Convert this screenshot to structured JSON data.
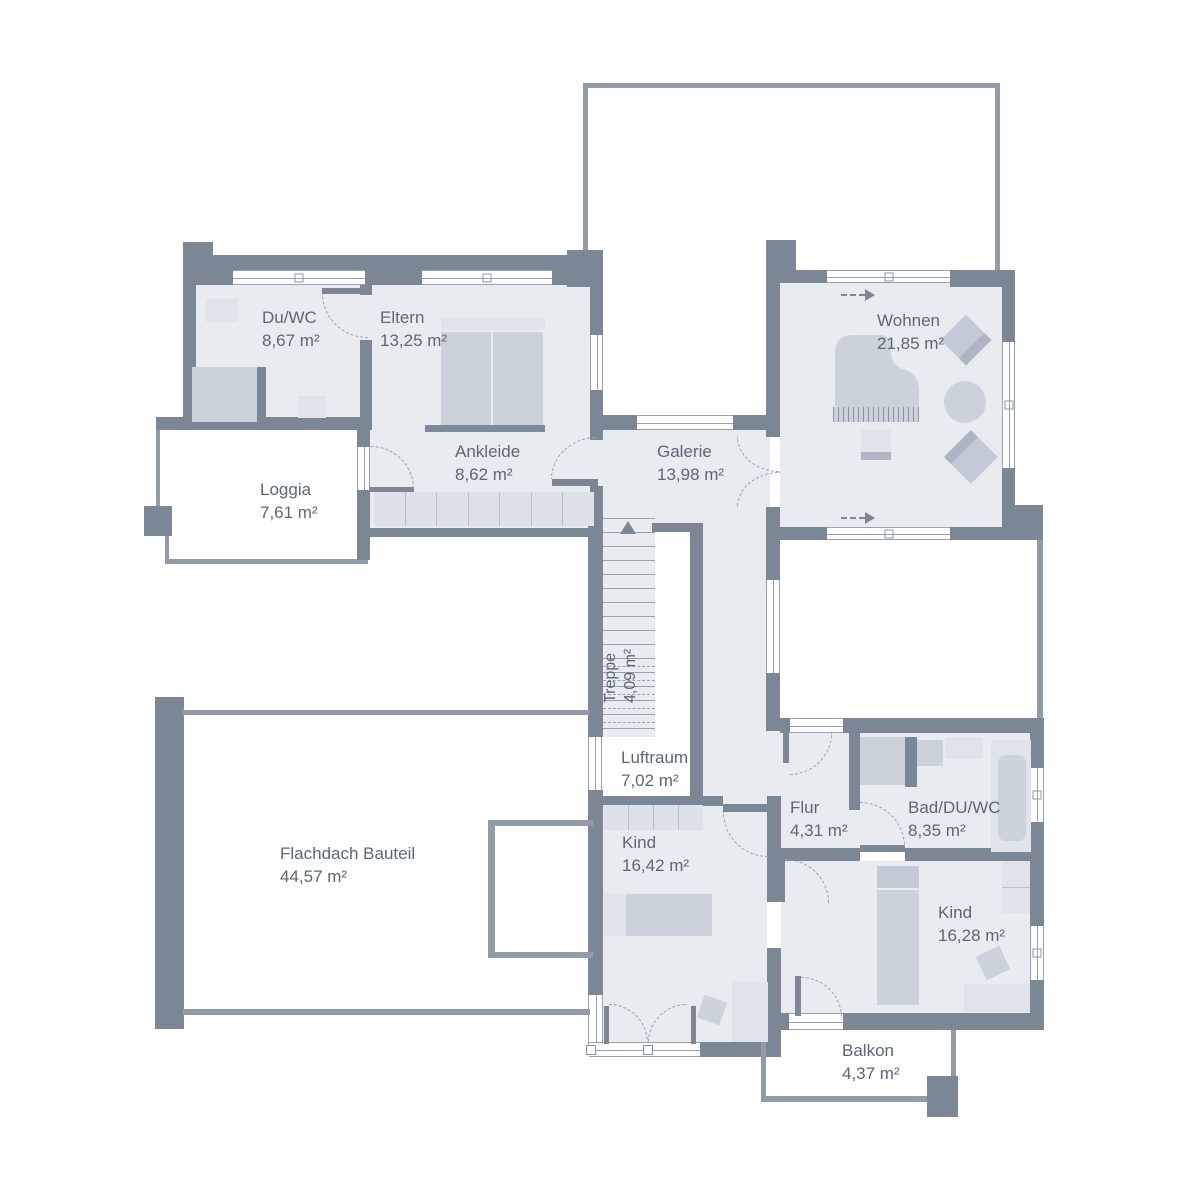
{
  "rooms": {
    "du_wc": {
      "name": "Du/WC",
      "area": "8,67 m²"
    },
    "eltern": {
      "name": "Eltern",
      "area": "13,25 m²"
    },
    "ankleide": {
      "name": "Ankleide",
      "area": "8,62 m²"
    },
    "loggia": {
      "name": "Loggia",
      "area": "7,61 m²"
    },
    "galerie": {
      "name": "Galerie",
      "area": "13,98 m²"
    },
    "wohnen": {
      "name": "Wohnen",
      "area": "21,85 m²"
    },
    "treppe": {
      "name": "Treppe",
      "area": "4,09 m²"
    },
    "luftraum": {
      "name": "Luftraum",
      "area": "7,02 m²"
    },
    "flachdach": {
      "name": "Flachdach Bauteil",
      "area": "44,57 m²"
    },
    "kind1": {
      "name": "Kind",
      "area": "16,42 m²"
    },
    "flur": {
      "name": "Flur",
      "area": "4,31 m²"
    },
    "bad": {
      "name": "Bad/DU/WC",
      "area": "8,35 m²"
    },
    "kind2": {
      "name": "Kind",
      "area": "16,28 m²"
    },
    "balkon": {
      "name": "Balkon",
      "area": "4,37 m²"
    }
  },
  "colors": {
    "wall": "#7b8795",
    "wall_thin": "#929ca8",
    "room_fill": "#e8ecf1",
    "furniture": "#cbd2dc",
    "furniture_light": "#dfe3ea",
    "text": "#5c6775",
    "background": "#ffffff"
  }
}
